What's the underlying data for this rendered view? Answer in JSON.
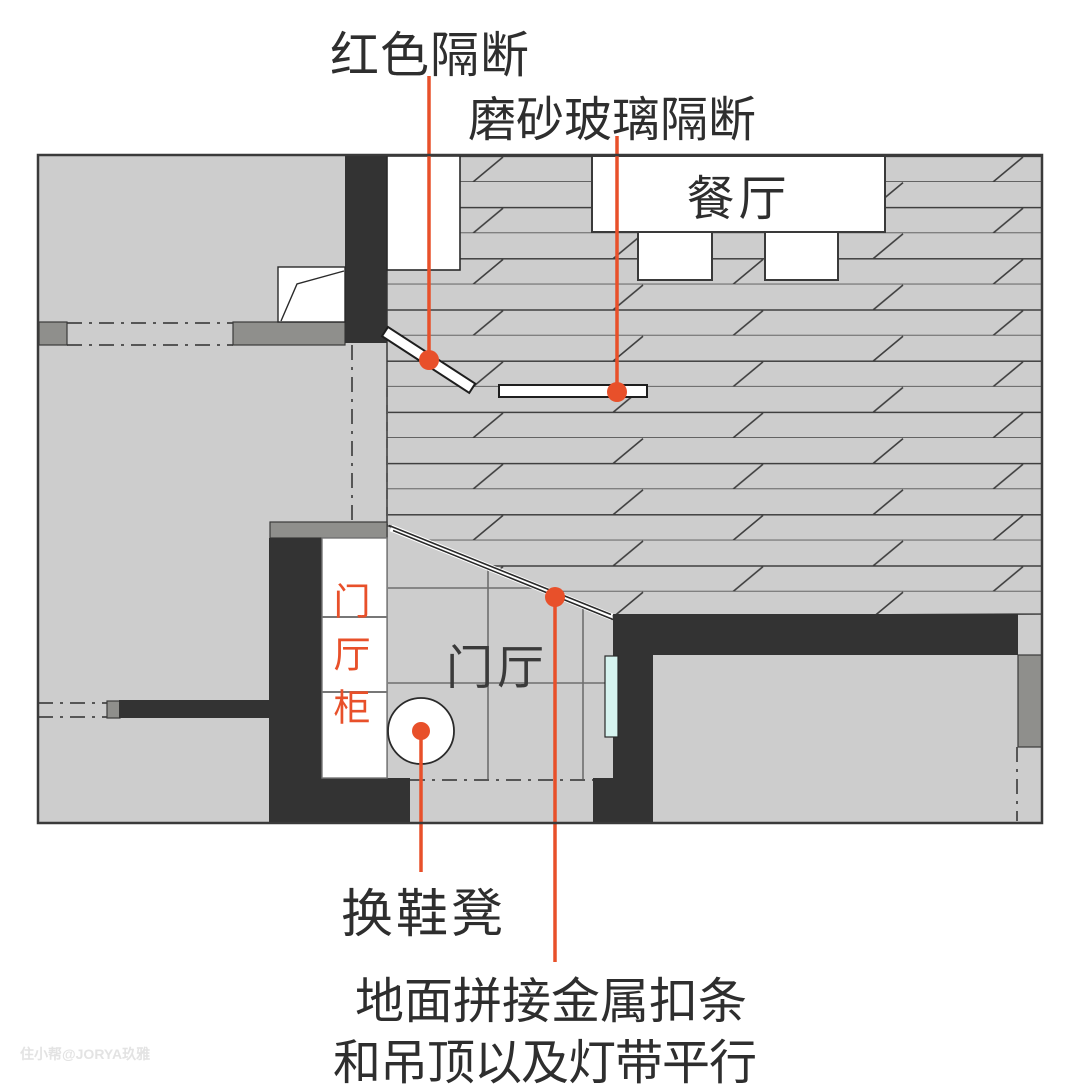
{
  "diagram_type": "interior floor plan (entrance + dining area) with hand-drawn callout annotations",
  "palette": {
    "background": "#ffffff",
    "floor_gray": "#cdcdcd",
    "wall_dark": "#333333",
    "outline_dark": "#3a3a3a",
    "sill_gray": "#8f8f8c",
    "accent_red": "#e8502a",
    "glass_cyan": "#d6f3ef",
    "text_black": "#2e2e2e",
    "watermark_gray": "#e3e3e3"
  },
  "annotations": {
    "red_partition": "红色隔断",
    "frosted_glass_partition": "磨砂玻璃隔断",
    "shoe_stool": "换鞋凳",
    "metal_strip_line1": "地面拼接金属扣条",
    "metal_strip_line2": "和吊顶以及灯带平行"
  },
  "rooms": {
    "dining": "餐厅",
    "foyer": "门厅",
    "foyer_cabinet": "门厅柜"
  },
  "watermark": "住小帮@JORYA玖雅",
  "legend_notes": {
    "hatched_area": "wood plank flooring in dining area",
    "grid_area": "tile flooring in entrance hall",
    "red_dots_and_lines": "leader lines pointing from labels to plan elements"
  }
}
